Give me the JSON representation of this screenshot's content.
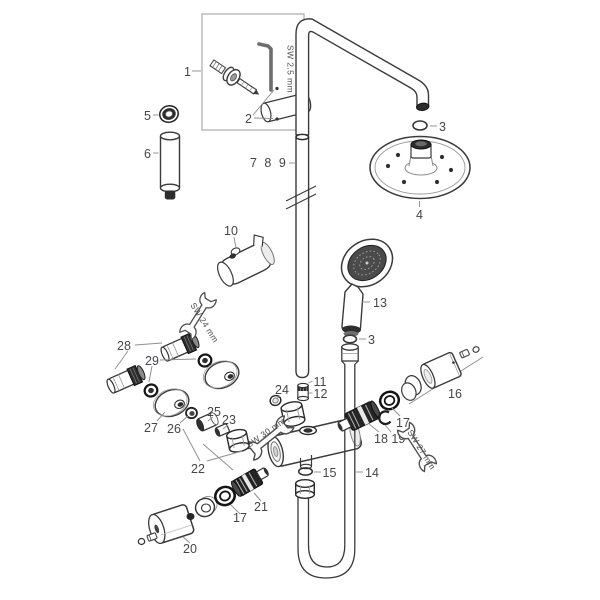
{
  "diagram": {
    "type": "exploded-parts-diagram",
    "subject": "showerpipe with overhead shower, hand shower and thermostatic mixer",
    "colors": {
      "background": "#ffffff",
      "line": "#3a3a3a",
      "dark_part": "#262626",
      "leader": "#8f8f8f",
      "label_text": "#45454b",
      "box_outline": "#9a9a9a"
    },
    "labels": {
      "p1": "1",
      "p2": "2",
      "p3_arm": "3",
      "p3_hose": "3",
      "p4": "4",
      "p5": "5",
      "p6": "6",
      "p789": "7 8 9",
      "p10": "10",
      "p11": "11",
      "p12": "12",
      "p13": "13",
      "p14": "14",
      "p15": "15",
      "p16": "16",
      "p17_right": "17",
      "p17_left": "17",
      "p18_19": "18 19",
      "p20": "20",
      "p21": "21",
      "p22": "22",
      "p23": "23",
      "p24": "24",
      "p25": "25",
      "p26": "26",
      "p27": "27",
      "p28": "28",
      "p29": "29"
    },
    "tools": {
      "allen_key": "SW 2.5 mm",
      "wrench_24": "SW 24 mm",
      "wrench_30": "SW 30 mm",
      "wrench_27": "SW 27 mm"
    }
  }
}
